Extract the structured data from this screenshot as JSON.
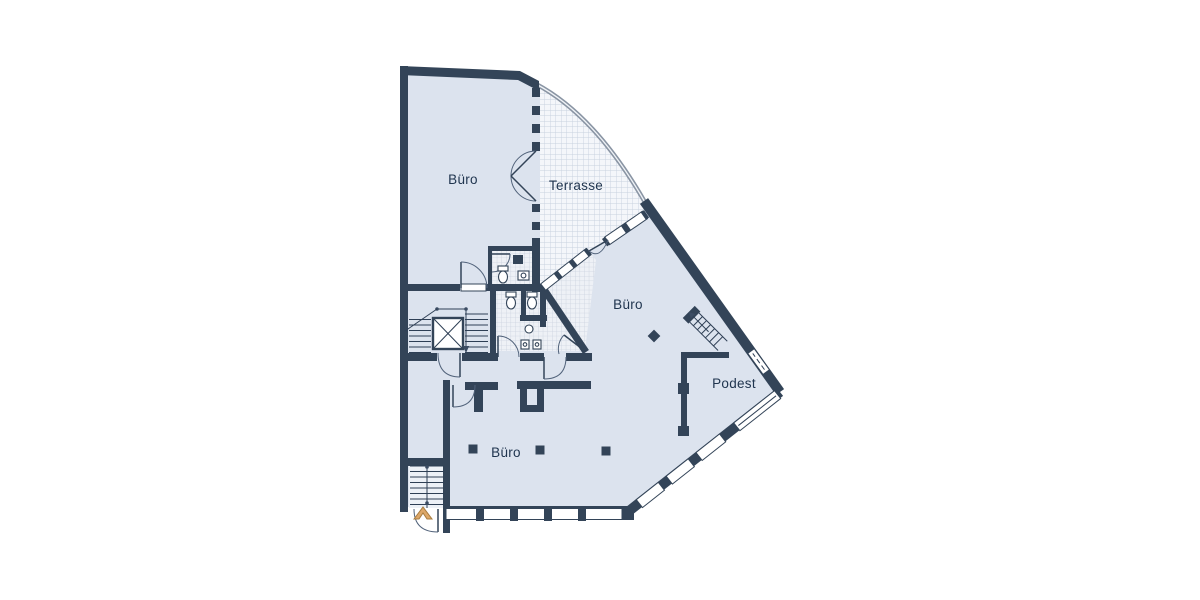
{
  "page": {
    "background_color": "#ffffff"
  },
  "plan": {
    "type": "architectural-floor-plan",
    "colors": {
      "wall": "#334458",
      "room_fill": "#dce3ee",
      "terrace_fill": "#f4f6fa",
      "grid_line": "#c8d1de",
      "wc_fill": "#eef1f6",
      "label_text": "#20354f",
      "railing": "#8a95a4",
      "window_pane": "#ffffff",
      "entrance_arrow": "#dda768",
      "entrance_arrow_border": "#a87c3f"
    },
    "rooms": {
      "buero_top": {
        "label": "Büro"
      },
      "terrasse": {
        "label": "Terrasse"
      },
      "buero_middle": {
        "label": "Büro"
      },
      "podest": {
        "label": "Podest"
      },
      "buero_bottom": {
        "label": "Büro"
      }
    }
  }
}
